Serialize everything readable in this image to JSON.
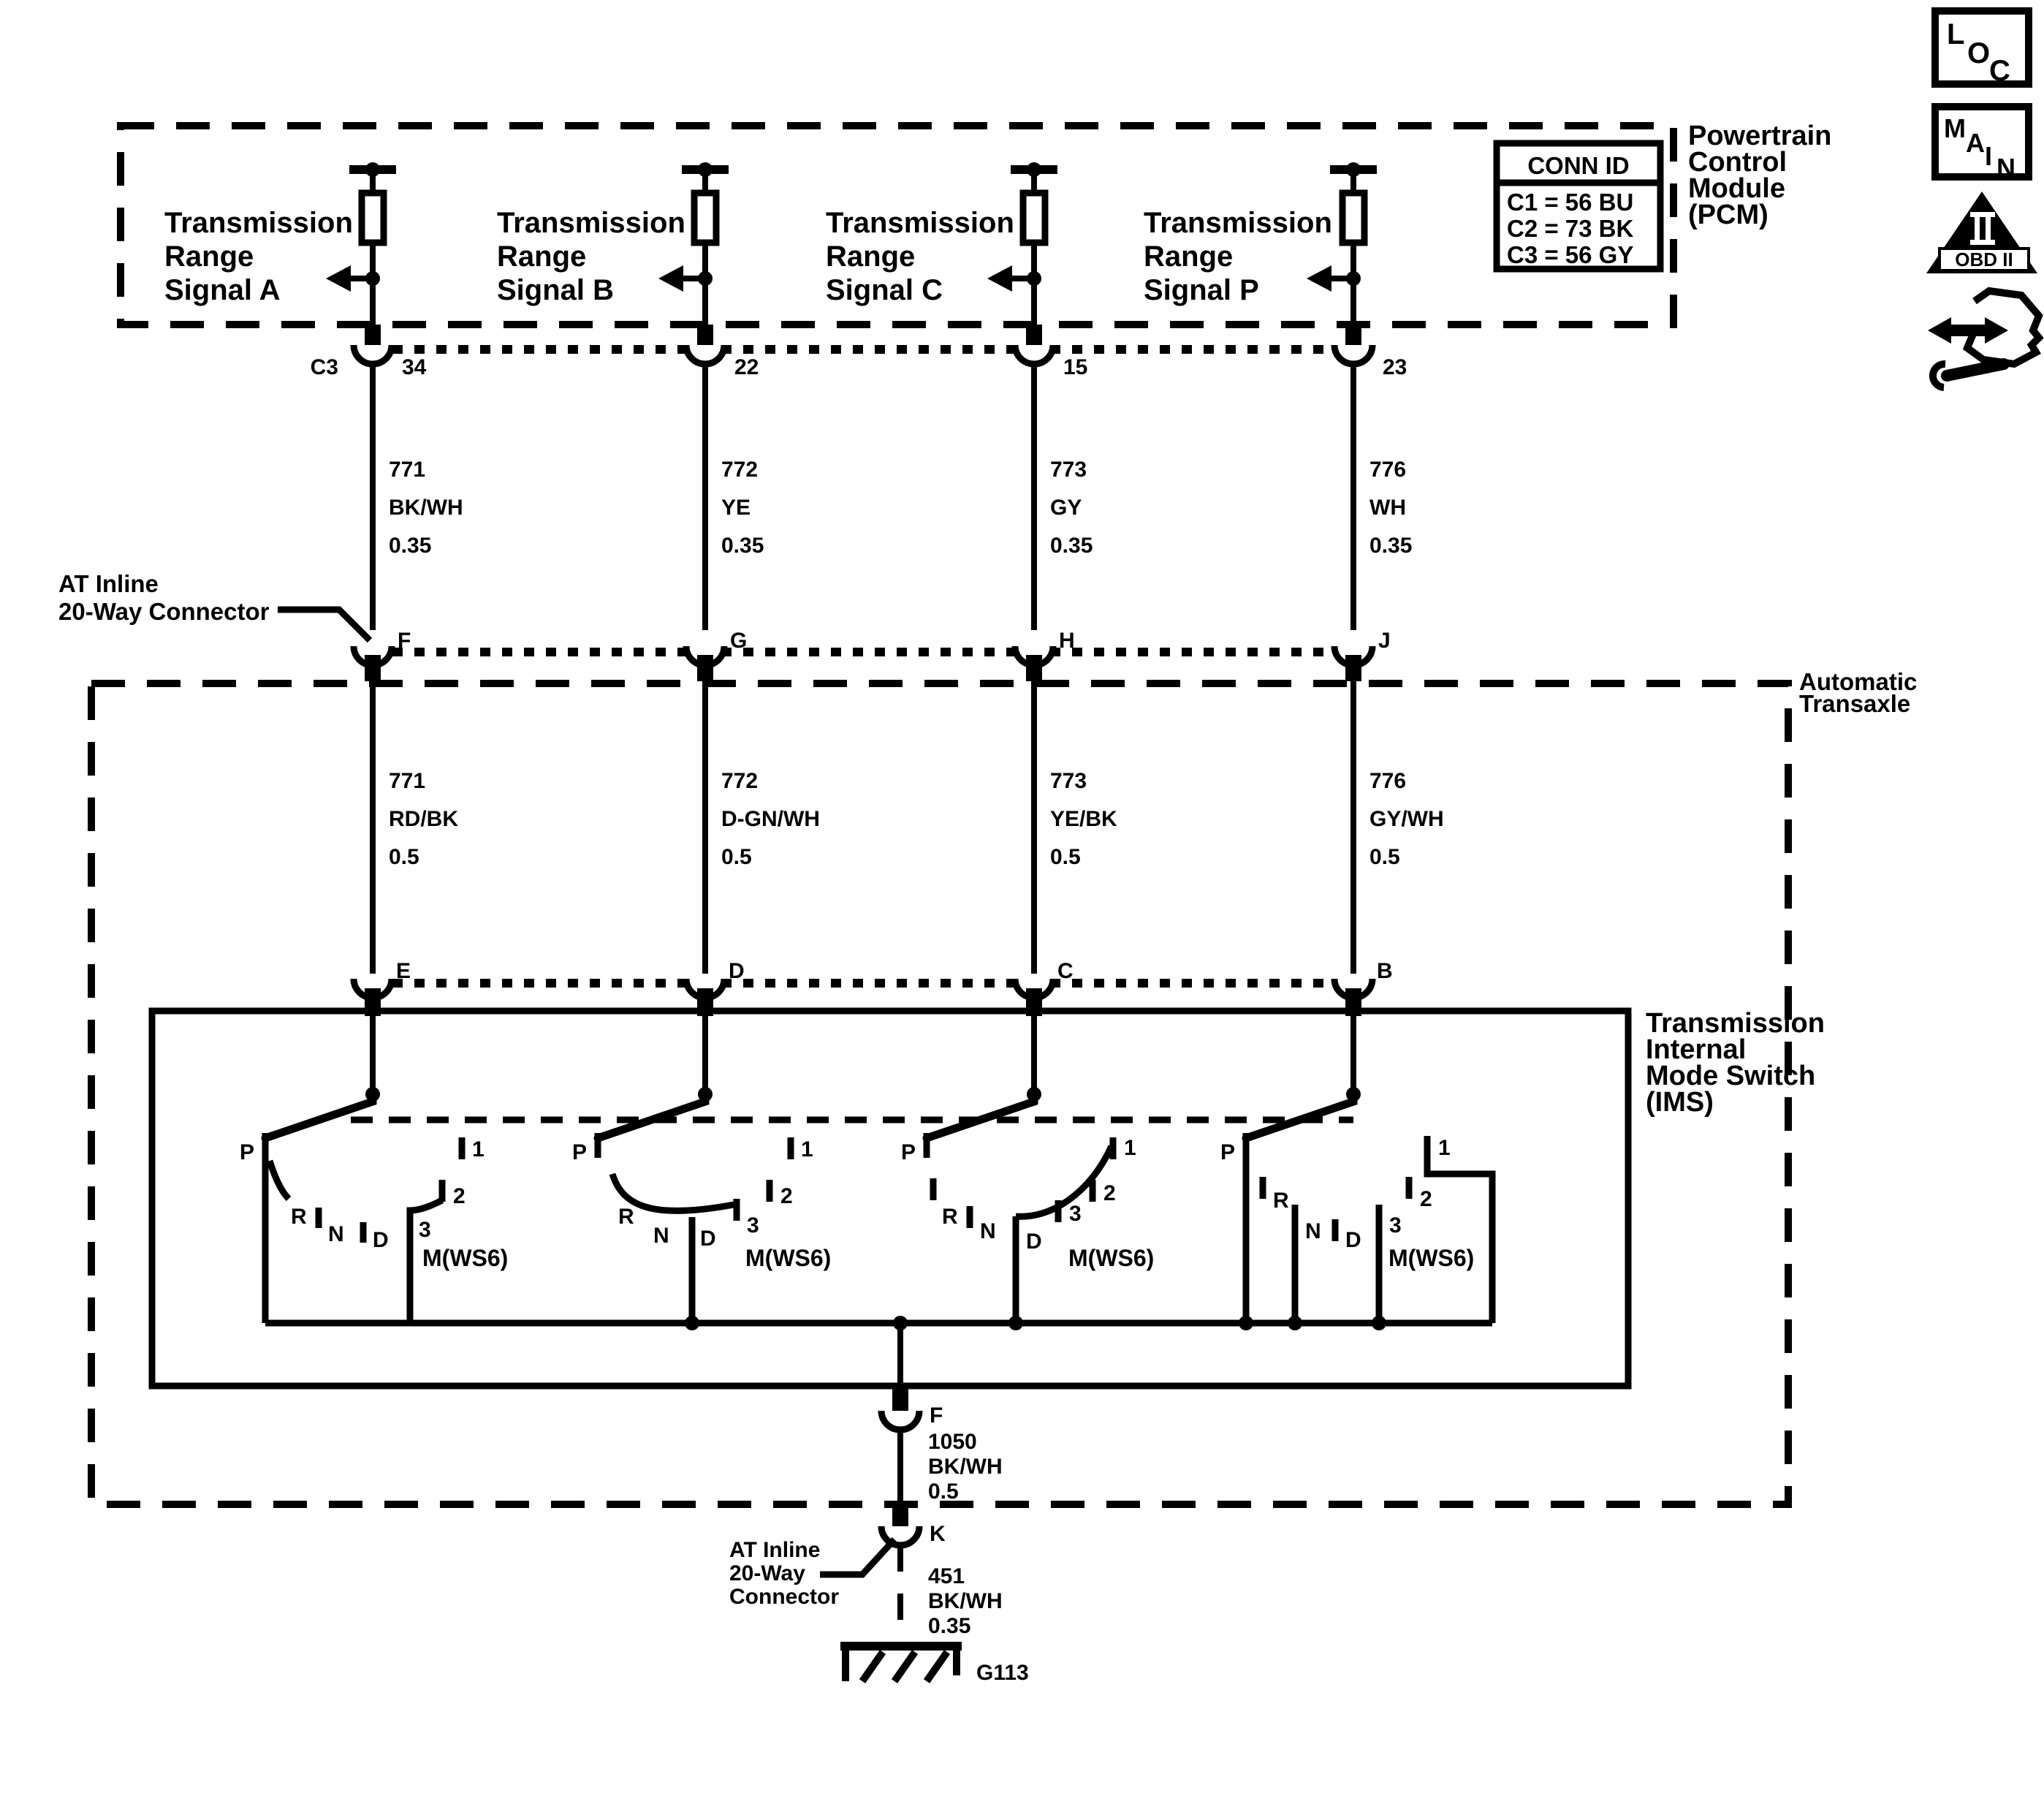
{
  "badges": {
    "loc_letters": [
      "L",
      "O",
      "C"
    ],
    "main_letters": [
      "M",
      "A",
      "I",
      "N"
    ],
    "obd_numeral": "II",
    "obd_label": "OBD II"
  },
  "pcm": {
    "label_lines": [
      "Powertrain",
      "Control",
      "Module",
      "(PCM)"
    ],
    "conn_table": {
      "header": "CONN ID",
      "rows": [
        "C1 = 56 BU",
        "C2 = 73 BK",
        "C3 = 56 GY"
      ]
    }
  },
  "signals": [
    {
      "label_lines": [
        "Transmission",
        "Range",
        "Signal A"
      ],
      "pcm_conn": "C3",
      "pcm_pin": "34",
      "upper_wire": [
        "771",
        "BK/WH",
        "0.35"
      ],
      "inline_pin": "F",
      "lower_wire": [
        "771",
        "RD/BK",
        "0.5"
      ],
      "ims_pin": "E"
    },
    {
      "label_lines": [
        "Transmission",
        "Range",
        "Signal B"
      ],
      "pcm_pin": "22",
      "upper_wire": [
        "772",
        "YE",
        "0.35"
      ],
      "inline_pin": "G",
      "lower_wire": [
        "772",
        "D-GN/WH",
        "0.5"
      ],
      "ims_pin": "D"
    },
    {
      "label_lines": [
        "Transmission",
        "Range",
        "Signal C"
      ],
      "pcm_pin": "15",
      "upper_wire": [
        "773",
        "GY",
        "0.35"
      ],
      "inline_pin": "H",
      "lower_wire": [
        "773",
        "YE/BK",
        "0.5"
      ],
      "ims_pin": "C"
    },
    {
      "label_lines": [
        "Transmission",
        "Range",
        "Signal P"
      ],
      "pcm_pin": "23",
      "upper_wire": [
        "776",
        "WH",
        "0.35"
      ],
      "inline_pin": "J",
      "lower_wire": [
        "776",
        "GY/WH",
        "0.5"
      ],
      "ims_pin": "B"
    }
  ],
  "at_inline_label_top": [
    "AT Inline",
    "20-Way Connector"
  ],
  "transaxle_label": [
    "Automatic",
    "Transaxle"
  ],
  "ims_label": [
    "Transmission",
    "Internal",
    "Mode Switch",
    "(IMS)"
  ],
  "switch_labels": {
    "p": "P",
    "r": "R",
    "n": "N",
    "d": "D",
    "pos1": "1",
    "pos2": "2",
    "pos3": "3",
    "mode": "M(WS6)"
  },
  "ground_path": {
    "ims_pin": "F",
    "wire_upper": [
      "1050",
      "BK/WH",
      "0.5"
    ],
    "inline_pin": "K",
    "inline_label": [
      "AT Inline",
      "20-Way",
      "Connector"
    ],
    "wire_lower": [
      "451",
      "BK/WH",
      "0.35"
    ],
    "ground_id": "G113"
  }
}
